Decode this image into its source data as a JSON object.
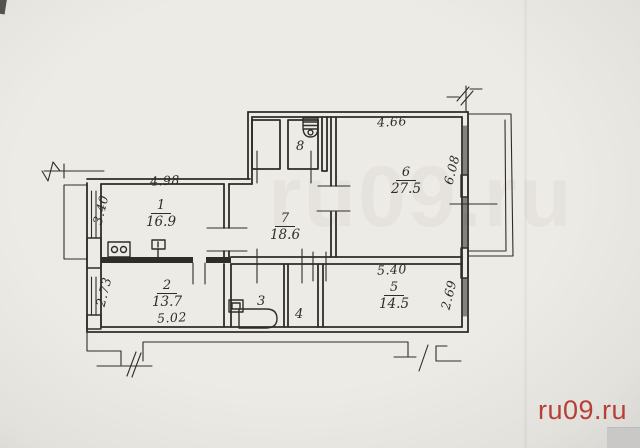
{
  "colors": {
    "ink": "#2f2d29",
    "paper": "#eae8e3",
    "watermark": "#b4382e"
  },
  "watermark": {
    "text": "ru09.ru"
  },
  "plan": {
    "rooms": [
      {
        "number": "1",
        "area": "16.9"
      },
      {
        "number": "2",
        "area": "13.7"
      },
      {
        "number": "3",
        "area": ""
      },
      {
        "number": "4",
        "area": ""
      },
      {
        "number": "5",
        "area": "14.5"
      },
      {
        "number": "6",
        "area": "27.5"
      },
      {
        "number": "7",
        "area": "18.6"
      },
      {
        "number": "8",
        "area": ""
      }
    ],
    "dims": {
      "room1_top": "4.98",
      "balcony_left": "3.40",
      "room2_left": "2.73",
      "room2_bottom": "5.02",
      "room6_top": "4.66",
      "room6_right": "6.08",
      "room5_top": "5.40",
      "room5_right": "2.69"
    }
  }
}
